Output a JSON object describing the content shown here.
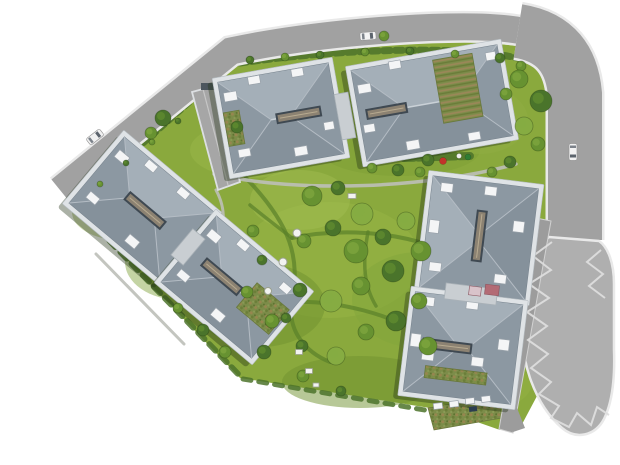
{
  "palette": {
    "background": "#ffffff",
    "lawn_base": "#8aa93d",
    "road": "#a1a1a1",
    "road_casing": "#e9e9e9",
    "plaza": "#afafaf",
    "driveway": "#9c9c9c",
    "ramp": "#a6a6a6",
    "ramp_wall": "#dcdfe2",
    "roof_base": "#94a0aa",
    "roof_light": "#a4afb8",
    "roof_dark": "#85919b",
    "roof_side": "#8c98a2",
    "roof_edge": "#76828c",
    "ridge": "#cad1d7",
    "hip": "#b4bcc4",
    "wall": "#dfe3e6",
    "wall_edge": "#b6bdc2",
    "shadow": "rgba(35,50,20,0.38)",
    "skylight_frame": "#3f4952",
    "skylight_fill": "#8c8272",
    "skylight_line": "#b7aa90",
    "box_fill": "#f4f5f6",
    "box_edge": "#99a2aa",
    "link_fill": "#c9ced2",
    "link_edge": "#a9b1b7",
    "green_roof_edge": "#68773c",
    "tree_tones": [
      "#4a742b",
      "#679231",
      "#86ac42"
    ],
    "tree_edge": "rgba(25,45,12,0.35)",
    "hedge": "#4c732a",
    "path_green": "#5a8029",
    "path_gray": "#bcbfb8",
    "marking": "#dddddd",
    "car_glass": "#5c646d",
    "furniture_fill": "#f2f3f0",
    "furniture_edge": "#9aa08f"
  },
  "scene": {
    "site": {
      "outline": [
        [
          76,
          196
        ],
        [
          238,
          56
        ],
        [
          300,
          47
        ],
        [
          380,
          41
        ],
        [
          450,
          40
        ],
        [
          520,
          46
        ],
        [
          546,
          58
        ],
        [
          552,
          80
        ],
        [
          552,
          232
        ],
        [
          547,
          238
        ],
        [
          530,
          258
        ],
        [
          523,
          296
        ],
        [
          525,
          356
        ],
        [
          537,
          396
        ],
        [
          520,
          428
        ],
        [
          500,
          430
        ],
        [
          460,
          416
        ],
        [
          430,
          408
        ],
        [
          330,
          392
        ],
        [
          240,
          378
        ],
        [
          72,
          202
        ]
      ]
    },
    "lawn_patches": [
      [
        250,
        150,
        60,
        28,
        "#9ab84a",
        0.5
      ],
      [
        400,
        150,
        80,
        26,
        "#7d9f36",
        0.5
      ],
      [
        330,
        260,
        90,
        58,
        "#97b546",
        0.55
      ],
      [
        260,
        305,
        65,
        42,
        "#6f9230",
        0.5
      ],
      [
        420,
        300,
        68,
        48,
        "#82a63c",
        0.5
      ],
      [
        180,
        262,
        55,
        38,
        "#7d9f36",
        0.45
      ],
      [
        480,
        120,
        48,
        34,
        "#8fae44",
        0.5
      ],
      [
        360,
        382,
        78,
        26,
        "#6f9230",
        0.5
      ],
      [
        120,
        212,
        48,
        28,
        "#89a83e",
        0.4
      ],
      [
        495,
        385,
        36,
        22,
        "#97b546",
        0.4
      ],
      [
        300,
        200,
        50,
        30,
        "#a5c155",
        0.4
      ]
    ],
    "hedges": [
      {
        "d": "M 240,63 C 330,50 460,44 522,59",
        "w": 7,
        "dash": "7 5"
      },
      {
        "d": "M 86,194 L 234,63",
        "w": 6,
        "dash": "6 5"
      },
      {
        "d": "M 76,206 L 240,376",
        "w": 6,
        "dash": "9 7"
      },
      {
        "d": "M 243,379 L 448,414",
        "w": 5,
        "dash": "8 8"
      },
      {
        "d": "M 404,158 L 470,156",
        "w": 8,
        "dash": "10 4"
      }
    ],
    "paths_green": [
      {
        "d": "M 246,178 C 292,226 300,258 292,302 C 287,330 305,352 330,362",
        "w": 4
      },
      {
        "d": "M 292,238 C 340,228 392,232 432,246",
        "w": 4
      },
      {
        "d": "M 292,302 C 342,300 390,316 424,334",
        "w": 4
      },
      {
        "d": "M 368,232 C 362,264 364,286 376,306",
        "w": 3.5
      },
      {
        "d": "M 250,205 C 268,220 282,230 292,238",
        "w": 3.5
      },
      {
        "d": "M 424,334 C 448,352 460,368 464,382",
        "w": 3.5
      }
    ],
    "paths_gray": [
      {
        "d": "M 150,112 L 196,92",
        "w": 3
      },
      {
        "d": "M 216,190 C 228,212 224,232 214,250",
        "w": 3
      },
      {
        "d": "M 214,174 C 300,194 430,188 516,164",
        "w": 3.5
      },
      {
        "d": "M 96,254 L 184,344",
        "w": 3
      },
      {
        "d": "M 545,298 L 514,300",
        "w": 4
      }
    ],
    "ground_gardens": [
      [
        [
          428,
          408
        ],
        [
          498,
          396
        ],
        [
          502,
          418
        ],
        [
          434,
          430
        ]
      ]
    ],
    "roads": {
      "main": {
        "d": "M 60,190 L 231,51 C 305,35 395,28 448,27 C 494,26 521,29 536,35",
        "w": 27
      },
      "right": {
        "d": "M 518,31 C 556,37 572,60 575,94 L 575,240",
        "w": 54
      },
      "plaza_d": "M 549,237 C 535,247 527,266 523,292 C 519,318 521,352 530,378 C 537,398 548,416 562,428 C 576,440 595,436 604,419 C 612,403 615,378 614,350 L 614,284 C 614,263 608,247 599,241 Z",
      "driveway_pts": [
        [
          536,
          218
        ],
        [
          551,
          221
        ],
        [
          513,
          433
        ],
        [
          499,
          429
        ]
      ],
      "side_path_pts": [
        [
          500,
          396
        ],
        [
          511,
          393
        ],
        [
          525,
          428
        ],
        [
          513,
          432
        ]
      ]
    },
    "ramp": {
      "pts": [
        [
          192,
          92
        ],
        [
          214,
          86
        ],
        [
          240,
          182
        ],
        [
          218,
          190
        ]
      ],
      "divider": [
        [
          203,
          89
        ],
        [
          228,
          185
        ]
      ],
      "block": [
        201,
        83,
        13,
        7
      ]
    },
    "zigzags": [
      [
        [
          552,
          242
        ],
        [
          533,
          256
        ],
        [
          551,
          270
        ],
        [
          529,
          284
        ],
        [
          549,
          298
        ],
        [
          527,
          312
        ],
        [
          547,
          326
        ],
        [
          528,
          340
        ],
        [
          548,
          354
        ],
        [
          531,
          368
        ],
        [
          551,
          382
        ],
        [
          539,
          394
        ],
        [
          559,
          406
        ],
        [
          551,
          418
        ],
        [
          569,
          427
        ],
        [
          577,
          413
        ],
        [
          591,
          425
        ],
        [
          597,
          407
        ],
        [
          609,
          415
        ]
      ],
      [
        [
          601,
          250
        ],
        [
          587,
          262
        ],
        [
          603,
          274
        ],
        [
          589,
          286
        ],
        [
          605,
          298
        ]
      ]
    ],
    "buildings": [
      {
        "id": "A1",
        "cx": 281,
        "cy": 118,
        "w": 112,
        "h": 92,
        "rot": -10,
        "skylight": {
          "len": 44,
          "off": 18
        },
        "green_roof": [
          -48,
          2,
          16,
          34
        ],
        "garden_rows": false,
        "boxes": [
          [
            -46,
            -30,
            13,
            9
          ],
          [
            -20,
            -42,
            12,
            8
          ],
          [
            24,
            -42,
            12,
            8
          ],
          [
            -42,
            28,
            12,
            8
          ],
          [
            14,
            36,
            13,
            9
          ],
          [
            46,
            16,
            10,
            8
          ]
        ]
      },
      {
        "id": "A2",
        "cx": 432,
        "cy": 103,
        "w": 148,
        "h": 92,
        "rot": -10,
        "skylight": {
          "len": 40,
          "off": -46
        },
        "green_roof": [
          28,
          -10,
          40,
          64
        ],
        "garden_rows": true,
        "boxes": [
          [
            -64,
            -26,
            13,
            9
          ],
          [
            -30,
            -44,
            12,
            8
          ],
          [
            -66,
            14,
            11,
            8
          ],
          [
            -26,
            38,
            13,
            9
          ],
          [
            36,
            40,
            12,
            8
          ],
          [
            66,
            -36,
            10,
            8
          ]
        ]
      },
      {
        "id": "B1",
        "cx": 142,
        "cy": 208,
        "w": 118,
        "h": 86,
        "rot": 40,
        "skylight": {
          "len": 46,
          "off": 4
        },
        "green_roof": null,
        "garden_rows": false,
        "boxes": [
          [
            -48,
            -26,
            13,
            9
          ],
          [
            -20,
            -38,
            12,
            8
          ],
          [
            22,
            -38,
            12,
            8
          ],
          [
            -44,
            24,
            12,
            8
          ],
          [
            14,
            32,
            13,
            9
          ]
        ]
      },
      {
        "id": "B2",
        "cx": 234,
        "cy": 287,
        "w": 118,
        "h": 86,
        "rot": 40,
        "skylight": {
          "len": 46,
          "off": -16
        },
        "green_roof": [
          36,
          -2,
          42,
          32
        ],
        "garden_rows": false,
        "boxes": [
          [
            -48,
            -26,
            13,
            9
          ],
          [
            -20,
            -38,
            12,
            8
          ],
          [
            -46,
            24,
            12,
            8
          ],
          [
            6,
            32,
            13,
            9
          ],
          [
            40,
            -32,
            11,
            8
          ]
        ]
      },
      {
        "id": "C1",
        "cx": 479,
        "cy": 238,
        "w": 106,
        "h": 112,
        "rot": 7,
        "skylight": {
          "len": 50,
          "off": -2
        },
        "green_roof": null,
        "garden_rows": false,
        "boxes": [
          [
            -38,
            -46,
            12,
            9
          ],
          [
            6,
            -48,
            12,
            9
          ],
          [
            -46,
            -6,
            10,
            13
          ],
          [
            38,
            -16,
            11,
            11
          ],
          [
            -40,
            34,
            12,
            9
          ],
          [
            26,
            38,
            12,
            9
          ]
        ]
      },
      {
        "id": "C2",
        "cx": 463,
        "cy": 348,
        "w": 108,
        "h": 100,
        "rot": 7,
        "skylight": {
          "len": 48,
          "off": -16
        },
        "green_roof": [
          -4,
          28,
          62,
          12
        ],
        "garden_rows": false,
        "boxes": [
          [
            -40,
            -42,
            12,
            9
          ],
          [
            4,
            -44,
            12,
            9
          ],
          [
            -48,
            -2,
            10,
            13
          ],
          [
            40,
            -8,
            11,
            11
          ],
          [
            -34,
            12,
            12,
            9
          ],
          [
            16,
            12,
            12,
            9
          ]
        ]
      }
    ],
    "links": [
      [
        345,
        116,
        14,
        46,
        -10
      ],
      [
        188,
        247,
        16,
        34,
        40
      ],
      [
        471,
        294,
        52,
        16,
        7
      ]
    ],
    "entrances": [
      [
        492,
        290,
        14,
        10,
        7,
        "#b36b75"
      ],
      [
        475,
        291,
        12,
        9,
        7,
        "#d9c3ca"
      ]
    ],
    "terrace_row": {
      "rot": -7,
      "items": [
        [
          438,
          406,
          9,
          6
        ],
        [
          454,
          404,
          9,
          6
        ],
        [
          470,
          401,
          9,
          6
        ],
        [
          486,
          399,
          9,
          6
        ]
      ],
      "dark": [
        473,
        409,
        8,
        5
      ]
    },
    "trees": [
      [
        250,
        60,
        4,
        0
      ],
      [
        285,
        57,
        4,
        1
      ],
      [
        320,
        55,
        4,
        0
      ],
      [
        365,
        52,
        4,
        1
      ],
      [
        410,
        51,
        4,
        0
      ],
      [
        455,
        54,
        4,
        1
      ],
      [
        500,
        58,
        5,
        0
      ],
      [
        521,
        66,
        5,
        1
      ],
      [
        100,
        184,
        3,
        1
      ],
      [
        126,
        163,
        3,
        0
      ],
      [
        152,
        142,
        3,
        1
      ],
      [
        178,
        121,
        3,
        0
      ],
      [
        163,
        118,
        8,
        0
      ],
      [
        151,
        133,
        6,
        1
      ],
      [
        384,
        36,
        5,
        1
      ],
      [
        519,
        79,
        9,
        1
      ],
      [
        541,
        101,
        11,
        0
      ],
      [
        524,
        126,
        9,
        2
      ],
      [
        506,
        94,
        6,
        1
      ],
      [
        538,
        144,
        7,
        1
      ],
      [
        510,
        162,
        6,
        0
      ],
      [
        372,
        168,
        5,
        1
      ],
      [
        398,
        170,
        6,
        0
      ],
      [
        420,
        172,
        5,
        1
      ],
      [
        428,
        160,
        6,
        0
      ],
      [
        492,
        172,
        5,
        1
      ],
      [
        312,
        196,
        10,
        1
      ],
      [
        338,
        188,
        7,
        0
      ],
      [
        362,
        214,
        11,
        2
      ],
      [
        333,
        228,
        8,
        0
      ],
      [
        304,
        241,
        7,
        1
      ],
      [
        356,
        251,
        12,
        1
      ],
      [
        383,
        237,
        8,
        0
      ],
      [
        406,
        221,
        9,
        2
      ],
      [
        421,
        251,
        10,
        1
      ],
      [
        393,
        271,
        11,
        0
      ],
      [
        361,
        286,
        9,
        1
      ],
      [
        331,
        301,
        11,
        2
      ],
      [
        300,
        290,
        7,
        0
      ],
      [
        419,
        301,
        8,
        1
      ],
      [
        396,
        321,
        10,
        0
      ],
      [
        366,
        332,
        8,
        1
      ],
      [
        336,
        356,
        9,
        2
      ],
      [
        302,
        346,
        6,
        0
      ],
      [
        428,
        346,
        9,
        1
      ],
      [
        272,
        321,
        7,
        1
      ],
      [
        253,
        231,
        6,
        1
      ],
      [
        262,
        260,
        5,
        0
      ],
      [
        247,
        292,
        6,
        1
      ],
      [
        286,
        318,
        5,
        0
      ],
      [
        303,
        376,
        6,
        1
      ],
      [
        341,
        391,
        5,
        0
      ],
      [
        264,
        352,
        7,
        0
      ],
      [
        225,
        352,
        6,
        1
      ],
      [
        203,
        330,
        6,
        0
      ],
      [
        178,
        308,
        5,
        1
      ],
      [
        237,
        127,
        6,
        0
      ]
    ],
    "accents": [
      [
        443,
        161,
        3.5,
        "#c2342a"
      ],
      [
        468,
        157,
        3,
        "#2f7d33"
      ],
      [
        459,
        156,
        2.5,
        "#f0f0ee"
      ]
    ],
    "furniture_circles": [
      [
        297,
        233,
        4
      ],
      [
        283,
        262,
        4
      ],
      [
        268,
        291,
        3.5
      ]
    ],
    "furniture_rects": [
      [
        299,
        352,
        7,
        5
      ],
      [
        309,
        371,
        7,
        5
      ],
      [
        352,
        196,
        8,
        5
      ],
      [
        316,
        385,
        6,
        4
      ]
    ],
    "cars": [
      [
        95,
        137,
        -38,
        17,
        8,
        "#f1f1f1"
      ],
      [
        368,
        36,
        -5,
        16,
        8,
        "#f4f4f4"
      ],
      [
        573,
        152,
        90,
        17,
        8,
        "#f2f2f2"
      ]
    ]
  }
}
